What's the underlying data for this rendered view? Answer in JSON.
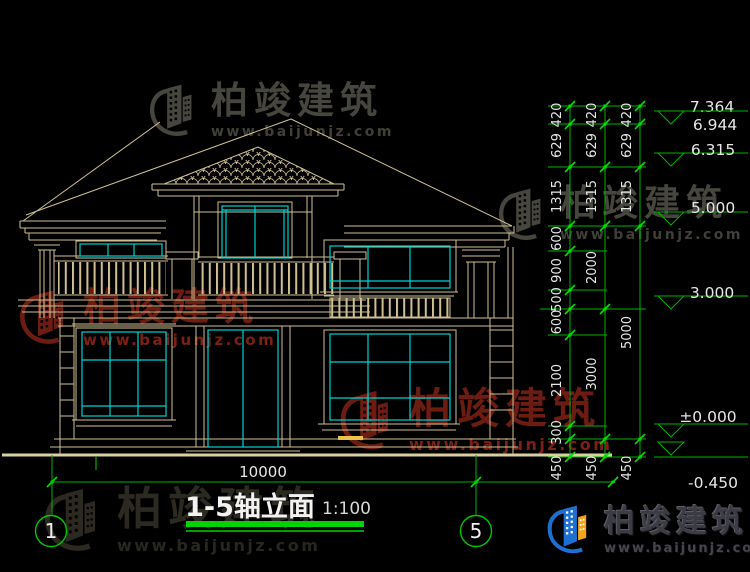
{
  "title_block": {
    "title": "1-5轴立面",
    "scale": "1:100"
  },
  "axis_bubbles": {
    "start": "1",
    "end": "5"
  },
  "bottom_dimension": {
    "label": "10000",
    "y": 482,
    "x1": 52,
    "x2": 615,
    "tick_xs": [
      52,
      476,
      613
    ],
    "label_x": 263,
    "label_y": 477
  },
  "dimension_columns": [
    {
      "x": 570,
      "segments": [
        [
          "420",
          106,
          124
        ],
        [
          "629",
          124,
          167
        ],
        [
          "1315",
          167,
          226
        ],
        [
          "600",
          226,
          251
        ],
        [
          "900",
          251,
          290
        ],
        [
          "500",
          290,
          309
        ],
        [
          "600",
          309,
          335
        ],
        [
          "2100",
          335,
          426
        ],
        [
          "300",
          426,
          439
        ],
        [
          "450",
          439,
          457
        ]
      ]
    },
    {
      "x": 605,
      "segments": [
        [
          "420",
          106,
          124
        ],
        [
          "629",
          124,
          167
        ],
        [
          "1315",
          167,
          226
        ],
        [
          "2000",
          226,
          309
        ],
        [
          "3000",
          309,
          439
        ],
        [
          "450",
          439,
          457
        ]
      ]
    },
    {
      "x": 640,
      "segments": [
        [
          "420",
          106,
          124
        ],
        [
          "629",
          124,
          167
        ],
        [
          "1315",
          167,
          226
        ],
        [
          "5000",
          226,
          439
        ],
        [
          "450",
          439,
          457
        ]
      ]
    }
  ],
  "extension_lines": [
    {
      "y": 106,
      "x1": 548,
      "x2": 646
    },
    {
      "y": 124,
      "x1": 548,
      "x2": 646
    },
    {
      "y": 167,
      "x1": 548,
      "x2": 646
    },
    {
      "y": 226,
      "x1": 548,
      "x2": 646
    },
    {
      "y": 309,
      "x1": 540,
      "x2": 646
    },
    {
      "y": 439,
      "x1": 548,
      "x2": 646
    },
    {
      "y": 457,
      "x1": 548,
      "x2": 646
    },
    {
      "y": 251,
      "x1": 548,
      "x2": 607
    },
    {
      "y": 290,
      "x1": 548,
      "x2": 607
    },
    {
      "y": 335,
      "x1": 548,
      "x2": 607
    },
    {
      "y": 426,
      "x1": 548,
      "x2": 607
    }
  ],
  "elevation_markers": [
    {
      "label": "7.364",
      "tx": 712,
      "ty": 107
    },
    {
      "label": "6.944",
      "tx": 715,
      "ty": 125,
      "line_y": 111,
      "apex_y": 124
    },
    {
      "label": "6.315",
      "tx": 713,
      "ty": 150,
      "line_y": 153,
      "apex_y": 166
    },
    {
      "label": "5.000",
      "tx": 713,
      "ty": 208,
      "line_y": 212,
      "apex_y": 225
    },
    {
      "label": "3.000",
      "tx": 712,
      "ty": 293,
      "line_y": 296,
      "apex_y": 309
    },
    {
      "label": "±0.000",
      "tx": 708,
      "ty": 417,
      "line_y": 424,
      "apex_y": 437
    },
    {
      "label": "-0.450",
      "tx": 713,
      "ty": 483,
      "line_y": 457,
      "apex_y": 455
    }
  ],
  "watermarks": [
    {
      "text": "柏竣建筑",
      "url": "www.baijunjz.com"
    },
    {
      "text": "柏竣建筑",
      "url": "www.baijunjz.com"
    },
    {
      "text": "柏竣建筑",
      "url": "www.baijunjz.com"
    },
    {
      "text": "柏竣建筑",
      "url": "www.baijunjz.com"
    },
    {
      "text": "柏竣建筑",
      "url": "www.baijunjz.com"
    }
  ],
  "logo": {
    "text": "柏竣建筑",
    "url": "www.baijunjz.com"
  },
  "colors": {
    "background": "#000000",
    "line_tan": "#cfc092",
    "window_cyan": "#00d2d2",
    "dimension_green": "#00b400",
    "tick_green": "#00e000",
    "ground_yellow": "#d9d09c",
    "text_white": "#e6e6e6",
    "underline_green": "#00d400",
    "watermark_red": "#6d1c12",
    "watermark_gray": "#46453e",
    "logo_blue": "#1d6fd1",
    "logo_orange": "#f2a41c"
  }
}
